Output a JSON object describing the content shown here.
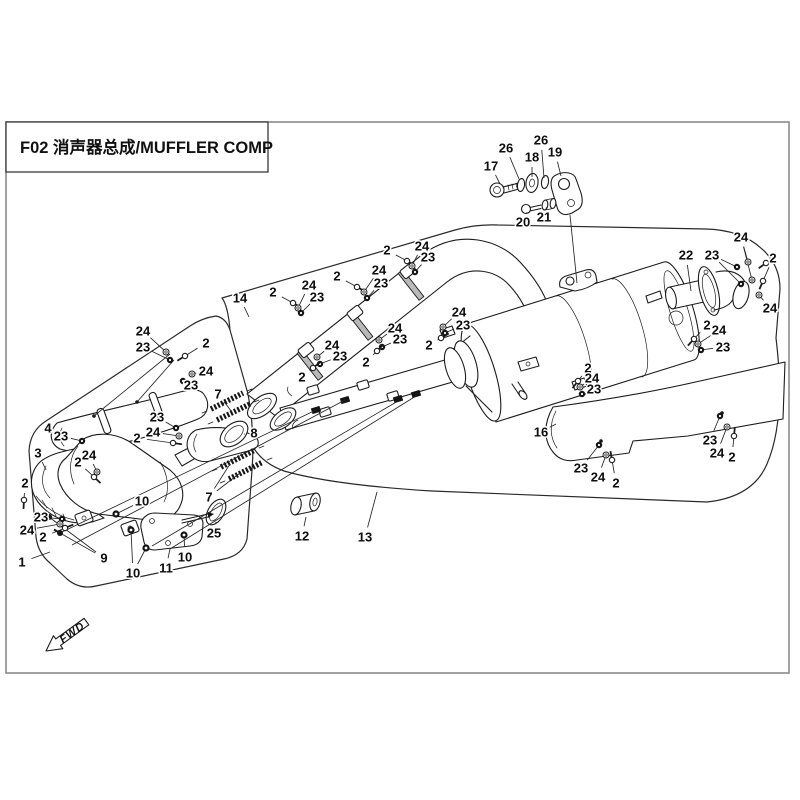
{
  "title": {
    "code_and_name": "F02 消声器总成/MUFFLER COMP"
  },
  "orientation": {
    "fwd_label": "FWD"
  },
  "colors": {
    "line": "#1c1c1c",
    "border": "#8a8a8a",
    "paper": "#ffffff",
    "hardware_dark": "#141414"
  },
  "diagram": {
    "description_parts": [
      "muffler-comp-outline-13",
      "front-pipe-assy-outline-1",
      "heat-shield-4",
      "front-pipe-3",
      "catalyst-body",
      "pipe-heat-shield-14",
      "mid-pipe",
      "muffler-body",
      "side-heat-shield-16",
      "tail-pipe-22",
      "hanger-bracket-19",
      "springs-7",
      "gasket-8",
      "gasket-25",
      "bracket-11",
      "bushing-12"
    ],
    "callouts": [
      {
        "t": "17",
        "x": 491,
        "y": 166,
        "l": [
          [
            500,
            184
          ]
        ]
      },
      {
        "t": "26",
        "x": 506,
        "y": 148,
        "l": [
          [
            519,
            179
          ]
        ]
      },
      {
        "t": "18",
        "x": 532,
        "y": 157,
        "l": [
          [
            532,
            177
          ]
        ]
      },
      {
        "t": "26",
        "x": 541,
        "y": 140,
        "l": [
          [
            544,
            178
          ]
        ]
      },
      {
        "t": "19",
        "x": 555,
        "y": 152,
        "l": [
          [
            561,
            176
          ]
        ]
      },
      {
        "t": "20",
        "x": 523,
        "y": 222,
        "l": [
          [
            527,
            212
          ]
        ]
      },
      {
        "t": "21",
        "x": 544,
        "y": 217,
        "l": [
          [
            546,
            209
          ]
        ]
      },
      {
        "t": "22",
        "x": 686,
        "y": 255,
        "l": [
          [
            691,
            291
          ]
        ]
      },
      {
        "t": "23",
        "x": 712,
        "y": 255,
        "l": [
          [
            737,
            267
          ],
          [
            741,
            284
          ]
        ]
      },
      {
        "t": "24",
        "x": 741,
        "y": 237,
        "l": [
          [
            748,
            262
          ],
          [
            752,
            280
          ]
        ]
      },
      {
        "t": "2",
        "x": 773,
        "y": 258,
        "l": [
          [
            766,
            263
          ],
          [
            763,
            281
          ]
        ]
      },
      {
        "t": "24",
        "x": 770,
        "y": 308,
        "l": [
          [
            759,
            295
          ]
        ]
      },
      {
        "t": "2",
        "x": 707,
        "y": 325,
        "l": [
          [
            694,
            339
          ]
        ]
      },
      {
        "t": "24",
        "x": 719,
        "y": 330,
        "l": [
          [
            698,
            344
          ]
        ]
      },
      {
        "t": "23",
        "x": 723,
        "y": 347,
        "l": [
          [
            701,
            350
          ]
        ]
      },
      {
        "t": "24",
        "x": 459,
        "y": 312,
        "l": [
          [
            443,
            327
          ]
        ]
      },
      {
        "t": "23",
        "x": 463,
        "y": 325,
        "l": [
          [
            445,
            333
          ]
        ]
      },
      {
        "t": "2",
        "x": 429,
        "y": 345,
        "l": [
          [
            441,
            338
          ]
        ]
      },
      {
        "t": "2",
        "x": 588,
        "y": 368,
        "l": [
          [
            578,
            381
          ]
        ]
      },
      {
        "t": "24",
        "x": 592,
        "y": 378,
        "l": [
          [
            580,
            387
          ]
        ]
      },
      {
        "t": "23",
        "x": 594,
        "y": 389,
        "l": [
          [
            582,
            394
          ]
        ]
      },
      {
        "t": "2",
        "x": 273,
        "y": 292,
        "l": [
          [
            293,
            303
          ]
        ]
      },
      {
        "t": "24",
        "x": 309,
        "y": 285,
        "l": [
          [
            298,
            308
          ]
        ]
      },
      {
        "t": "23",
        "x": 317,
        "y": 297,
        "l": [
          [
            301,
            313
          ]
        ]
      },
      {
        "t": "2",
        "x": 337,
        "y": 276,
        "l": [
          [
            357,
            287
          ]
        ]
      },
      {
        "t": "24",
        "x": 379,
        "y": 270,
        "l": [
          [
            364,
            292
          ]
        ]
      },
      {
        "t": "23",
        "x": 381,
        "y": 283,
        "l": [
          [
            367,
            298
          ]
        ]
      },
      {
        "t": "2",
        "x": 387,
        "y": 250,
        "l": [
          [
            407,
            261
          ]
        ]
      },
      {
        "t": "24",
        "x": 422,
        "y": 246,
        "l": [
          [
            412,
            266
          ]
        ]
      },
      {
        "t": "23",
        "x": 428,
        "y": 257,
        "l": [
          [
            415,
            272
          ]
        ]
      },
      {
        "t": "14",
        "x": 240,
        "y": 298,
        "l": [
          [
            249,
            317
          ]
        ]
      },
      {
        "t": "24",
        "x": 332,
        "y": 345,
        "l": [
          [
            317,
            357
          ]
        ]
      },
      {
        "t": "23",
        "x": 340,
        "y": 356,
        "l": [
          [
            320,
            364
          ]
        ]
      },
      {
        "t": "2",
        "x": 302,
        "y": 377,
        "l": [
          [
            313,
            368
          ]
        ]
      },
      {
        "t": "24",
        "x": 395,
        "y": 328,
        "l": [
          [
            379,
            340
          ]
        ]
      },
      {
        "t": "23",
        "x": 400,
        "y": 339,
        "l": [
          [
            382,
            347
          ]
        ]
      },
      {
        "t": "2",
        "x": 366,
        "y": 362,
        "l": [
          [
            377,
            351
          ]
        ]
      },
      {
        "t": "24",
        "x": 143,
        "y": 331,
        "l": [
          [
            166,
            352
          ]
        ]
      },
      {
        "t": "23",
        "x": 143,
        "y": 347,
        "l": [
          [
            170,
            360
          ]
        ]
      },
      {
        "t": "2",
        "x": 206,
        "y": 343,
        "l": [
          [
            185,
            356
          ]
        ]
      },
      {
        "t": "24",
        "x": 206,
        "y": 371,
        "l": [
          [
            192,
            374
          ]
        ]
      },
      {
        "t": "23",
        "x": 191,
        "y": 385,
        "l": [
          [
            183,
            381
          ]
        ]
      },
      {
        "t": "23",
        "x": 157,
        "y": 417,
        "l": [
          [
            176,
            428
          ]
        ]
      },
      {
        "t": "24",
        "x": 153,
        "y": 432,
        "l": [
          [
            179,
            436
          ]
        ]
      },
      {
        "t": "2",
        "x": 137,
        "y": 438,
        "l": [
          [
            173,
            443
          ]
        ]
      },
      {
        "t": "4",
        "x": 48,
        "y": 428,
        "l": [
          [
            58,
            432
          ]
        ]
      },
      {
        "t": "23",
        "x": 61,
        "y": 436,
        "l": [
          [
            82,
            441
          ]
        ]
      },
      {
        "t": "24",
        "x": 89,
        "y": 455,
        "l": [
          [
            97,
            472
          ]
        ]
      },
      {
        "t": "2",
        "x": 78,
        "y": 462,
        "l": [
          [
            94,
            477
          ]
        ]
      },
      {
        "t": "2",
        "x": 25,
        "y": 483,
        "l": [
          [
            24,
            500
          ]
        ]
      },
      {
        "t": "23",
        "x": 41,
        "y": 517,
        "l": [
          [
            62,
            519
          ]
        ]
      },
      {
        "t": "24",
        "x": 27,
        "y": 530,
        "l": [
          [
            60,
            524
          ]
        ]
      },
      {
        "t": "2",
        "x": 43,
        "y": 537,
        "l": [
          [
            65,
            528
          ]
        ]
      },
      {
        "t": "1",
        "x": 22,
        "y": 562,
        "l": [
          [
            50,
            552
          ]
        ]
      },
      {
        "t": "3",
        "x": 38,
        "y": 453,
        "l": [
          [
            46,
            470
          ]
        ]
      },
      {
        "t": "9",
        "x": 104,
        "y": 558,
        "l": [
          [
            49,
            517
          ],
          [
            60,
            533
          ]
        ]
      },
      {
        "t": "10",
        "x": 142,
        "y": 501,
        "l": [
          [
            116,
            514
          ]
        ]
      },
      {
        "t": "10",
        "x": 133,
        "y": 573,
        "l": [
          [
            131,
            530
          ],
          [
            146,
            548
          ]
        ]
      },
      {
        "t": "10",
        "x": 185,
        "y": 557,
        "l": [
          [
            184,
            535
          ]
        ]
      },
      {
        "t": "11",
        "x": 166,
        "y": 568,
        "l": [
          [
            170,
            549
          ]
        ]
      },
      {
        "t": "25",
        "x": 214,
        "y": 533,
        "l": [
          [
            216,
            522
          ]
        ]
      },
      {
        "t": "7",
        "x": 209,
        "y": 497,
        "l": [
          [
            230,
            464
          ],
          [
            240,
            473
          ]
        ]
      },
      {
        "t": "7",
        "x": 218,
        "y": 394,
        "l": [
          [
            224,
            404
          ],
          [
            232,
            412
          ]
        ]
      },
      {
        "t": "8",
        "x": 254,
        "y": 433,
        "l": [
          [
            245,
            434
          ]
        ]
      },
      {
        "t": "12",
        "x": 302,
        "y": 536,
        "l": [
          [
            306,
            517
          ]
        ]
      },
      {
        "t": "13",
        "x": 365,
        "y": 537,
        "l": [
          [
            377,
            492
          ]
        ]
      },
      {
        "t": "16",
        "x": 541,
        "y": 432,
        "l": [
          [
            556,
            424
          ]
        ]
      },
      {
        "t": "23",
        "x": 581,
        "y": 468,
        "l": [
          [
            599,
            445
          ]
        ]
      },
      {
        "t": "24",
        "x": 598,
        "y": 477,
        "l": [
          [
            606,
            455
          ]
        ]
      },
      {
        "t": "2",
        "x": 616,
        "y": 483,
        "l": [
          [
            612,
            460
          ]
        ]
      },
      {
        "t": "23",
        "x": 710,
        "y": 440,
        "l": [
          [
            720,
            416
          ]
        ]
      },
      {
        "t": "24",
        "x": 717,
        "y": 453,
        "l": [
          [
            727,
            427
          ]
        ]
      },
      {
        "t": "2",
        "x": 732,
        "y": 457,
        "l": [
          [
            734,
            436
          ]
        ]
      }
    ]
  }
}
